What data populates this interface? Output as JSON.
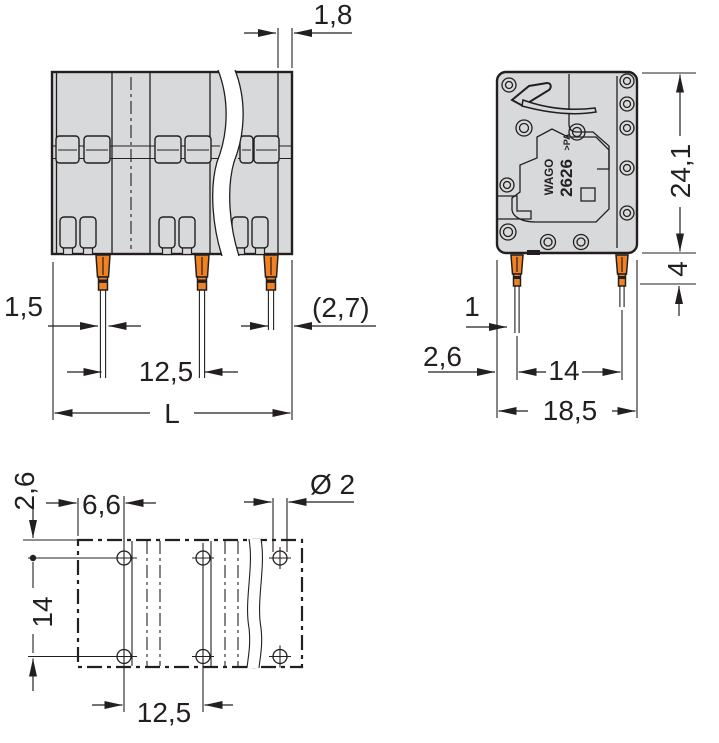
{
  "drawing": {
    "product_marking": {
      "brand": "WAGO",
      "series": "2626",
      "material": ">PA"
    },
    "front_view": {
      "dim_end_wall": "1,8",
      "dim_pin_width": "1,5",
      "dim_pitch": "12,5",
      "dim_length": "L",
      "dim_end_offset": "(2,7)"
    },
    "side_view": {
      "dim_height": "24,1",
      "dim_pin_length": "4",
      "dim_pin_width": "1",
      "dim_edge_offset": "2,6",
      "dim_pin_spacing": "14",
      "dim_depth": "18,5"
    },
    "footprint_view": {
      "dim_edge_to_row": "2,6",
      "dim_edge_to_hole": "6,6",
      "dim_hole_diameter": "Ø 2",
      "dim_row_spacing": "14",
      "dim_pitch": "12,5"
    },
    "colors": {
      "body": "#d8d9da",
      "pin_orange": "#f08223",
      "line": "#231f20",
      "background": "#ffffff"
    }
  }
}
